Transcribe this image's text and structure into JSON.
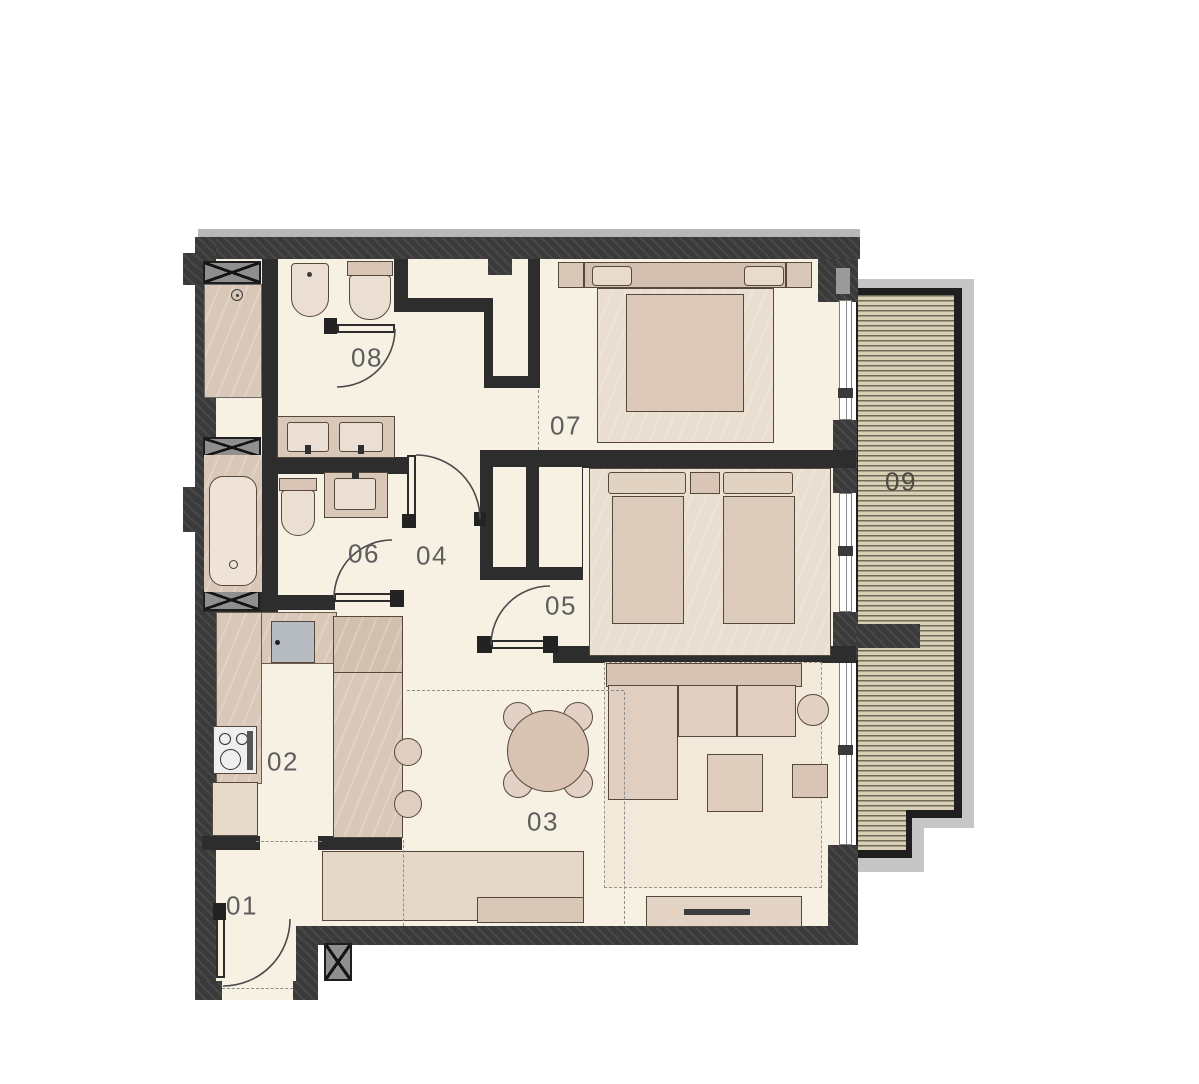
{
  "plan": {
    "type": "apartment-floor-plan",
    "room_labels": [
      {
        "id": "01",
        "label": "01",
        "role": "entrance-hall"
      },
      {
        "id": "02",
        "label": "02",
        "role": "kitchen"
      },
      {
        "id": "03",
        "label": "03",
        "role": "living-dining"
      },
      {
        "id": "04",
        "label": "04",
        "role": "hallway"
      },
      {
        "id": "05",
        "label": "05",
        "role": "bedroom"
      },
      {
        "id": "06",
        "label": "06",
        "role": "bathroom"
      },
      {
        "id": "07",
        "label": "07",
        "role": "bedroom"
      },
      {
        "id": "08",
        "label": "08",
        "role": "bathroom-wc"
      },
      {
        "id": "09",
        "label": "09",
        "role": "balcony"
      }
    ],
    "colors": {
      "wall": "#3a3a3a",
      "inner_wall": "#2d2d2d",
      "floor": "#f7f1e4",
      "furniture": "#d9c7b8",
      "furniture_light": "#e9decf",
      "fixture_light": "#eadfd2",
      "deck": "#d9cfb4",
      "deck_stripe": "#6f6b5a",
      "parapet": "#c6c6c6",
      "kitchen_sink": "#b6bbc1",
      "label_text": "#5d5d5d"
    }
  }
}
